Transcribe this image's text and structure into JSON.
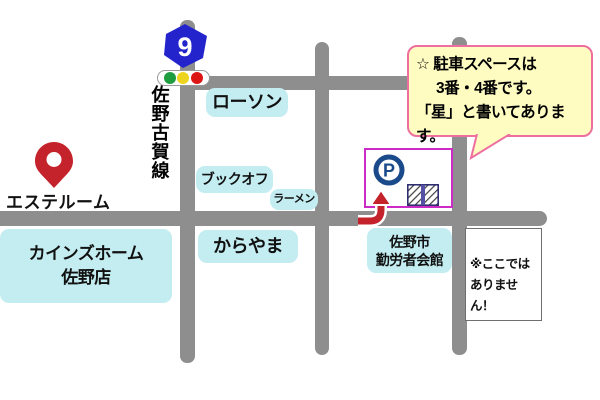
{
  "colors": {
    "road": "#8E8E8E",
    "label-bg": "#C3EDF1",
    "bubble-bg": "#FFFCC2",
    "bubble-border": "#EE6F9F",
    "parking-border": "#CC2BC5",
    "navy": "#1A4A8A",
    "red": "#C4232B",
    "shield-blue": "#2424CC",
    "hatch-divider": "#5552A6",
    "signal-green": "#1E9C40",
    "signal-yellow": "#EDD41E",
    "signal-red": "#DC1515"
  },
  "shield": {
    "number": "9"
  },
  "road_name": "佐野古賀線",
  "labels": {
    "lawson": "ローソン",
    "bookoff": "ブックオフ",
    "ramen": "ラーメン",
    "karayama": "からやま",
    "cainz_line1": "カインズホーム",
    "cainz_line2": "佐野店",
    "kaikan_line1": "佐野市",
    "kaikan_line2": "勤労者会館",
    "este": "エステルーム"
  },
  "callout": {
    "line1": "☆ 駐車スペースは",
    "line2": "3番・4番です。",
    "line3": "「星」と書いてあります。"
  },
  "note": {
    "line1": "※ここでは",
    "line2": "ありません！"
  },
  "parking": {
    "p": "P"
  }
}
